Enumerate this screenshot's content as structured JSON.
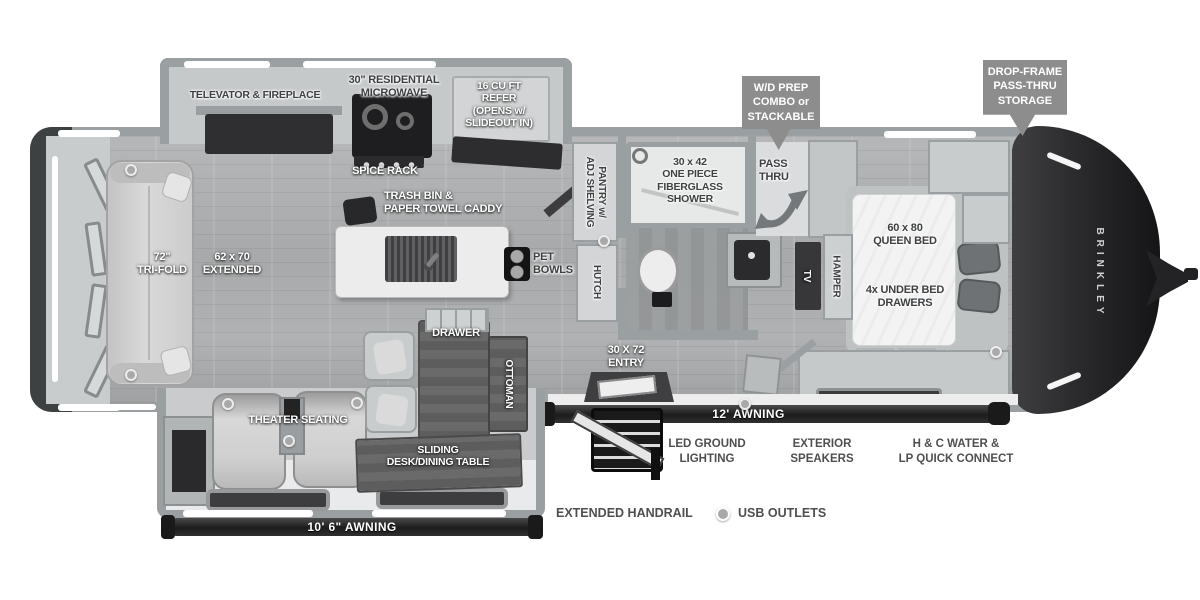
{
  "plan": {
    "brand": "BRINKLEY",
    "callouts": {
      "wd_prep": "W/D PREP\nCOMBO or\nSTACKABLE",
      "drop_frame": "DROP-FRAME\nPASS-THRU\nSTORAGE"
    },
    "kitchen": {
      "televator": "TELEVATOR & FIREPLACE",
      "microwave": "30\" RESIDENTIAL\nMICROWAVE",
      "refer": "16 CU FT\nREFER\n(OPENS w/\nSLIDEOUT IN)",
      "spice_rack": "SPICE RACK",
      "trash_caddy": "TRASH BIN &\nPAPER TOWEL CADDY",
      "pet_bowls": "PET\nBOWLS",
      "pantry": "PANTRY w/\nADJ SHELVING",
      "hutch": "HUTCH"
    },
    "living": {
      "tri_fold": "72\"\nTRI-FOLD",
      "slide_extended": "62 x 70\nEXTENDED",
      "theater": "THEATER SEATING",
      "desk": "SLIDING\nDESK/DINING TABLE",
      "drawer": "DRAWER",
      "ottoman": "OTTOMAN"
    },
    "bath": {
      "shower": "30 x 42\nONE PIECE\nFIBERGLASS\nSHOWER",
      "pass_thru": "PASS\nTHRU"
    },
    "bedroom": {
      "bed": "60 x 80\nQUEEN BED",
      "under_bed": "4x UNDER BED\nDRAWERS",
      "tv": "TV",
      "hamper": "HAMPER"
    },
    "entry": "30 X 72\nENTRY",
    "exterior": {
      "awning_rear": "10' 6\" AWNING",
      "awning_main": "12' AWNING",
      "led": "LED GROUND\nLIGHTING",
      "speakers": "EXTERIOR\nSPEAKERS",
      "water": "H & C WATER &\nLP QUICK CONNECT"
    },
    "legend": {
      "handrail": "EXTENDED HANDRAIL",
      "usb": "USB OUTLETS"
    },
    "colors": {
      "background": "#ffffff",
      "callout_gray": "#8d8d8d",
      "awning_black": "#242424",
      "wall_gray": "#9aa0a2",
      "front_cap": "#2a2a2c",
      "rear_cap": "#3e4142"
    }
  }
}
